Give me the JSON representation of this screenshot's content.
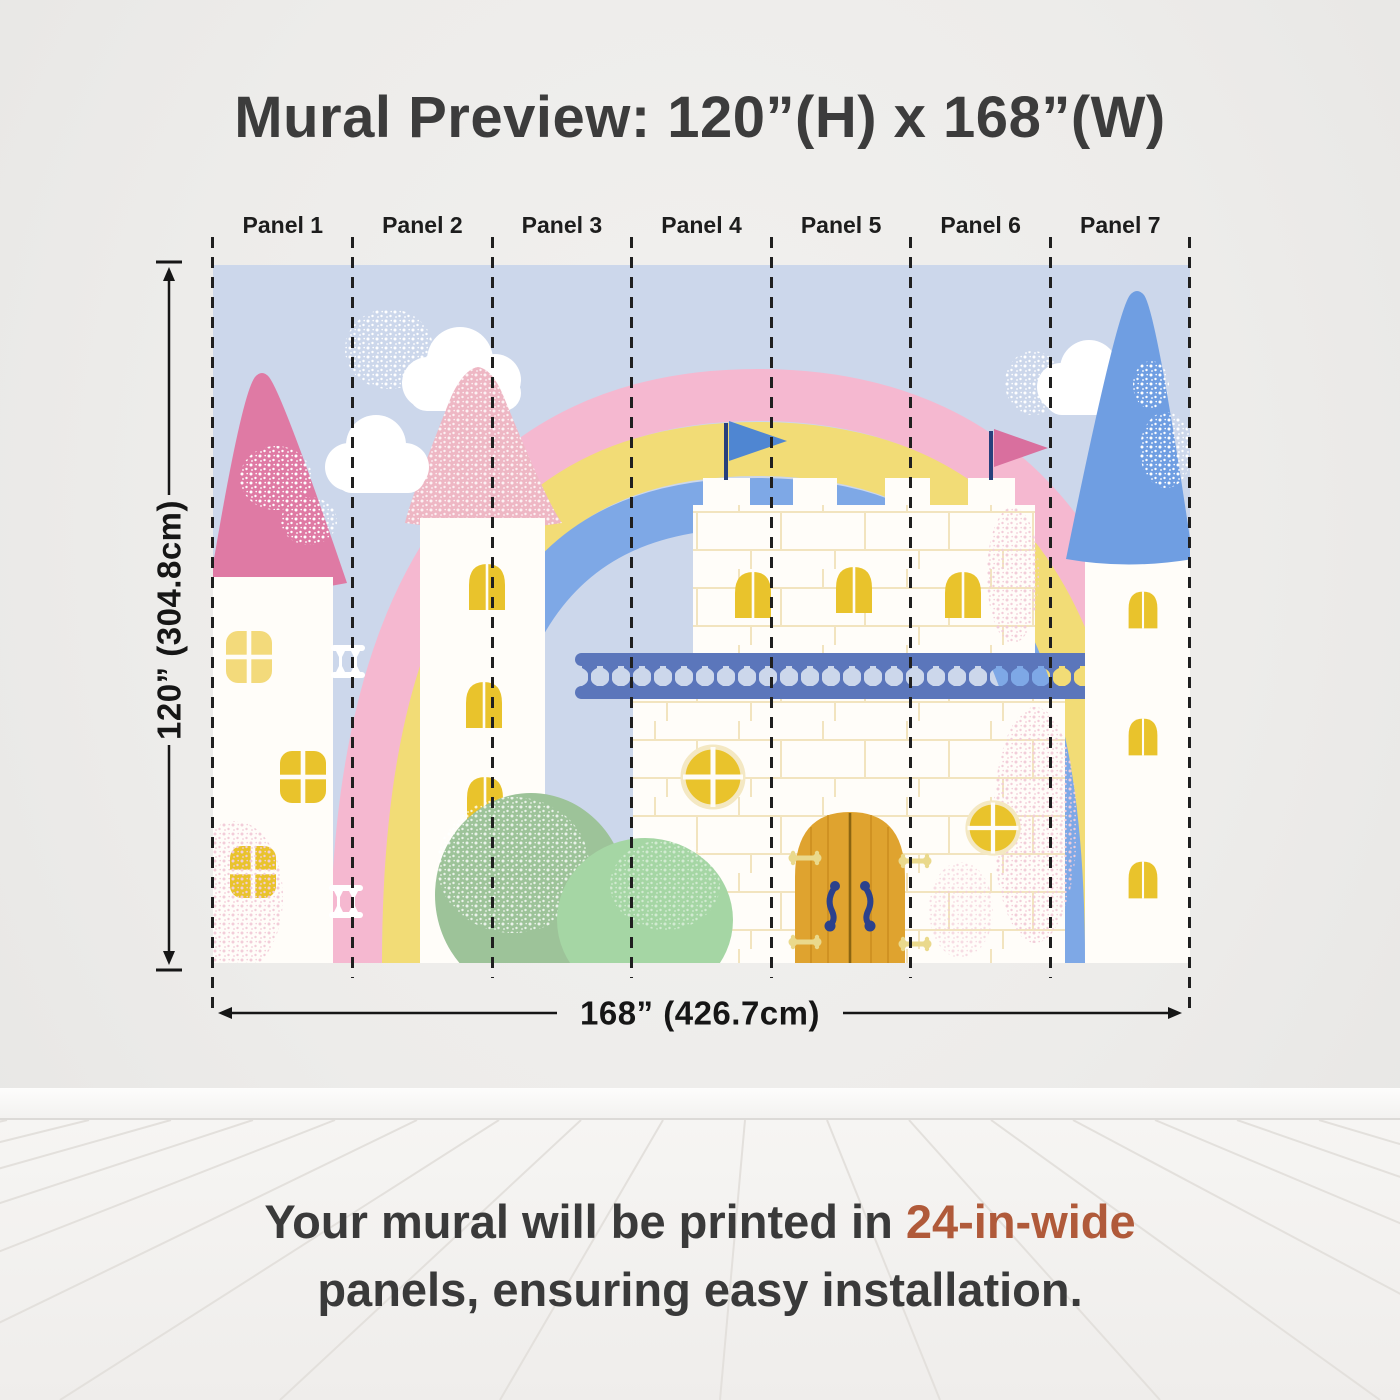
{
  "title": "Mural Preview: 120”(H) x 168”(W)",
  "panels": {
    "count": 7,
    "labels": [
      "Panel 1",
      "Panel 2",
      "Panel 3",
      "Panel 4",
      "Panel 5",
      "Panel 6",
      "Panel 7"
    ]
  },
  "dimensions": {
    "height_label": "120” (304.8cm)",
    "width_label": "168” (426.7cm)"
  },
  "caption": {
    "line1_prefix": "Your mural will be printed in ",
    "highlight": "24-in-wide",
    "line2": "panels, ensuring easy installation."
  },
  "illustration": {
    "description": "Pastel fairytale castle mural: pink cone-roof tower, speckled pink tower, rainbow, clouds, white castle keep with battlements, blue and pink flags, blue balcony railing, yellow windows, golden wooden door, green bush, blue cone-roof tower",
    "elements": [
      "left-pink-tower",
      "speckled-pink-tower",
      "rainbow",
      "clouds",
      "castle-keep",
      "blue-flag",
      "pink-flag",
      "balcony-railing",
      "round-windows",
      "wooden-door",
      "green-bush",
      "blue-roof-tower"
    ]
  },
  "colors": {
    "highlight_text": "#b05a3a",
    "title_text": "#3c3c3c",
    "sky": "#ccd7eb",
    "rainbow_pink": "#f5b8d0",
    "rainbow_yellow": "#f2dc76",
    "rainbow_blue": "#7ea8e6",
    "roof_pink": "#df7aa4",
    "roof_pink_light": "#eeb7c4",
    "roof_blue": "#6f9ee2",
    "window_yellow": "#e9c32c",
    "door_gold": "#dfa32f",
    "railing_blue": "#5b76bb",
    "bush_green": "#a5d6a4",
    "wall_white": "#fffdf9"
  }
}
